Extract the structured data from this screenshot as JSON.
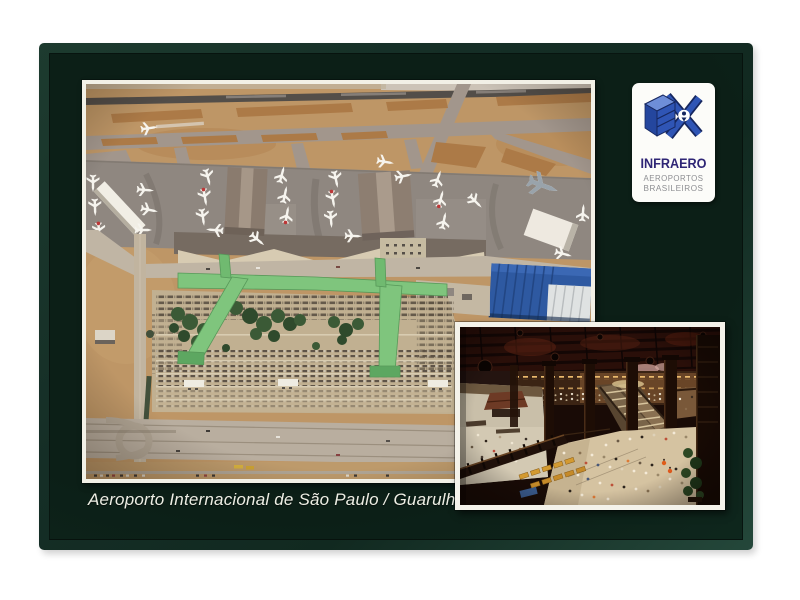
{
  "caption": "Aeroporto Internacional de São Paulo / Guarulhos",
  "badge": {
    "title": "INFRAERO",
    "subtitle1": "AEROPORTOS",
    "subtitle2": "BRASILEIROS"
  },
  "palette": {
    "page_background": "#ffffff",
    "card_green_dark": "#0c1f17",
    "card_green_frame": "#24473a",
    "photo_frame_white": "#f2f0e6",
    "badge_title_blue": "#2e2575",
    "badge_subtitle_gray": "#8d8e92",
    "logo_blue": "#2f55b5",
    "logo_blue_light": "#6e8ed8",
    "logo_navy": "#16275f",
    "aerial_grass_tan": "#c09663",
    "aerial_apron_gray": "#8f8780",
    "walkway_green": "#7cc67a",
    "cargo_roof_blue": "#2c59a5",
    "terminal_front_beige": "#d8cbb1",
    "interior_floor_beige": "#d6c3a0",
    "bench_orange": "#d59a2e"
  }
}
